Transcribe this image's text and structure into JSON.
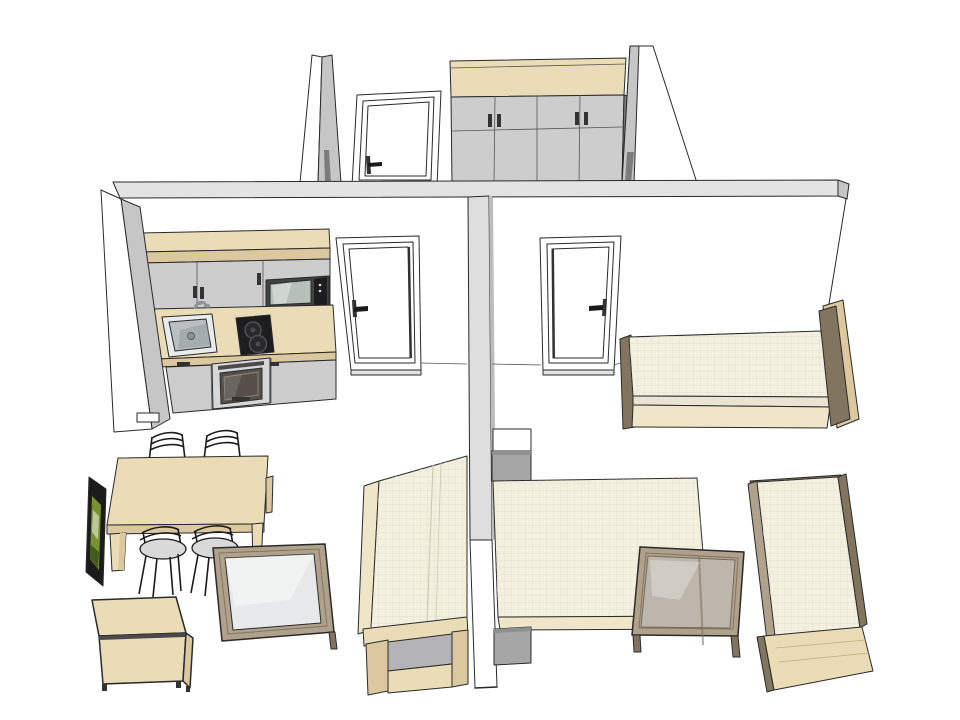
{
  "scene": {
    "view": "axonometric-3d-apartment-model",
    "background": "#ffffff",
    "canvas": {
      "width": 960,
      "height": 720
    }
  },
  "colors": {
    "outline": "#2a2a2a",
    "wall_top": "#e3e3e3",
    "wall_side": "#c6c6c6",
    "wall_center": "#dedede",
    "wall_center_edge": "#bdbdbd",
    "white": "#ffffff",
    "off_white": "#f4f4f4",
    "panel_gray": "#cdcdcd",
    "shadow_gray": "#7c7c7c",
    "cab_gray": "#a6a6a6",
    "cab_gray_top": "#8f8f8f",
    "inset_gray": "#b4b4b8",
    "wood": "#eadcb6",
    "wood_md": "#dcc89e",
    "wood_dk": "#c3ad84",
    "taupe": "#b0a18c",
    "taupe_dk": "#82755f",
    "mattress": "#f3f0df",
    "mattress_sd": "#e9e5d2",
    "mattress_ln": "#d9d5bd",
    "bedwood": "#efe5c8",
    "glass_frost": "#e8e9ea",
    "glass_clear": "#ccd1d4",
    "sink_rim": "#e9ebec",
    "metal": "#b9bfc3",
    "metal_dk": "#8d9499",
    "appl_dark": "#1d1d1f",
    "appl_frame": "#d7d7d7",
    "appl_handle": "#4a4a4a",
    "oven_glass": "#564f49",
    "micro_body": "#3f4543",
    "micro_win": "#b5c1b8",
    "screen_green": "#78902f",
    "screen_green_dk": "#3f5c1d",
    "seat_gray": "#d9d9d9",
    "chair_black": "#1b1b1b",
    "detail_dark": "#333333"
  },
  "objects": {
    "back_wall": "back partition wall (cutaway)",
    "left_wall": "left end wall",
    "center_wall": "central dividing wall",
    "right_wall": "right end wall edge",
    "corridor_pillar": "tapered wall segment",
    "corridor_door": "hallway door",
    "wardrobe": "four-door wardrobe with wooden top",
    "angled_wall": "angled wall segment",
    "kitchenette": "compact kitchen: upper cabinets, microwave, sink, two-burner cooktop, oven, base cabinets",
    "room1_door": "left room entry door",
    "room2_door": "right room entry door",
    "bed_single_right": "single bed with headboards",
    "nightstand": "two-tone bedside cabinet",
    "bed_left_vertical": "single bed (left room)",
    "bed_double": "double bed (right room)",
    "foot_cabinet": "gray cabinet at bed foot",
    "glass_table_left": "wood-framed frosted glass table",
    "glass_table_right": "wood-framed clear glass table",
    "bed_single_foreground": "single bed (foreground right)",
    "dining_table": "wooden dining table",
    "chairs": "four black wire chairs",
    "tv": "flat screen TV seen edge-on",
    "sideboard": "low wooden sideboard"
  }
}
